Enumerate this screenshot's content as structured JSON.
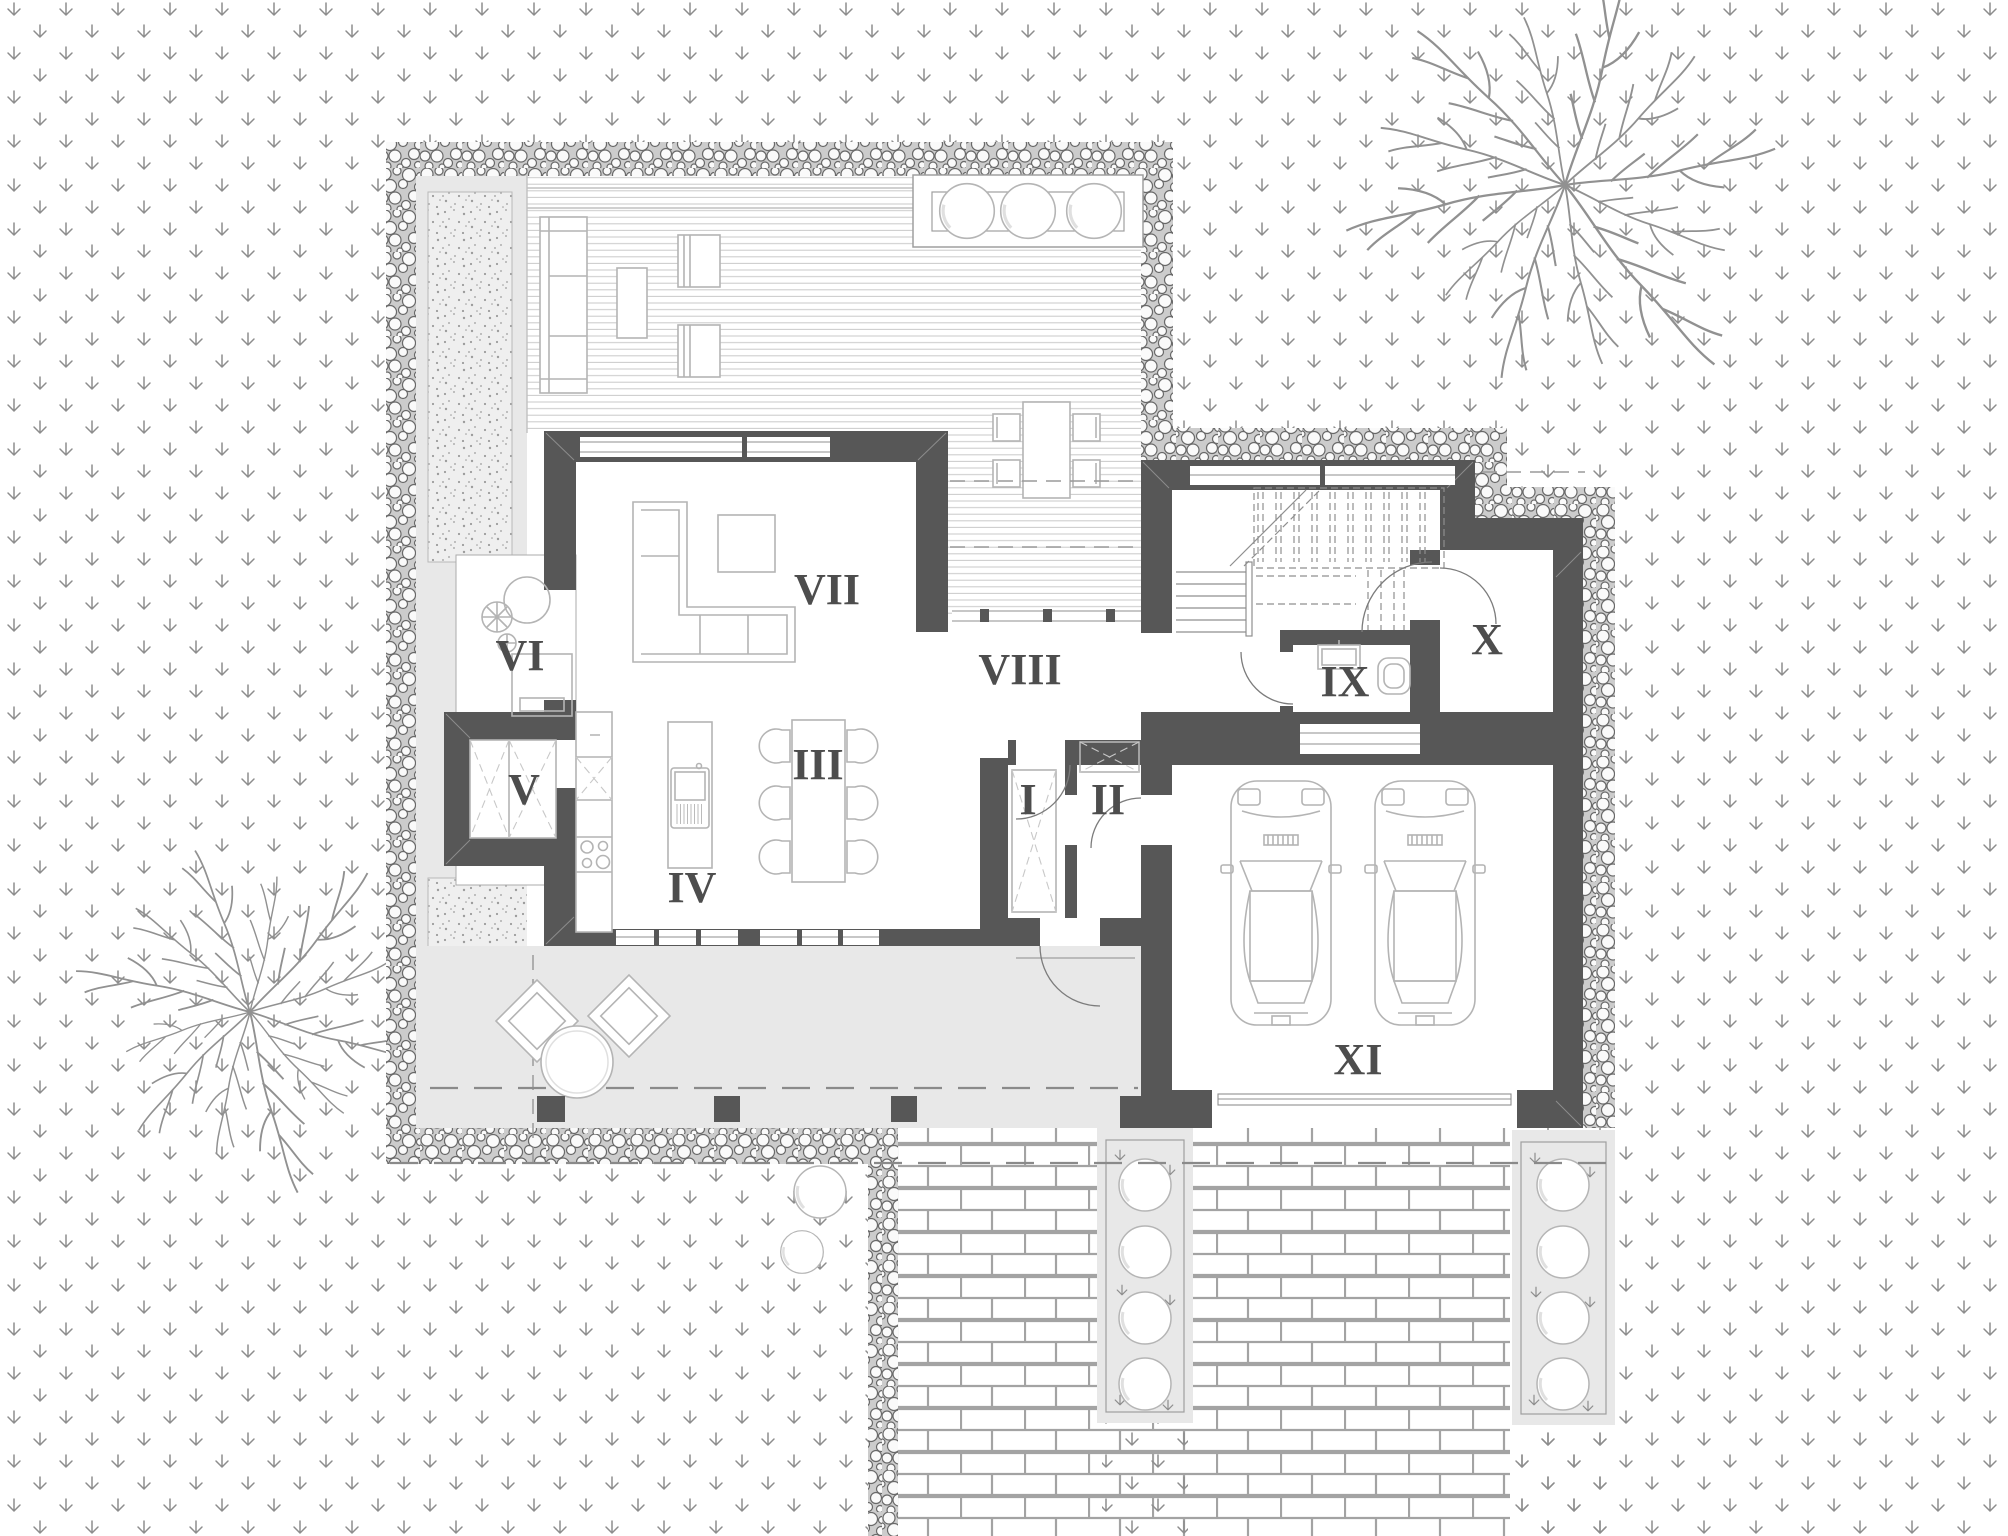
{
  "plan": {
    "rooms": [
      {
        "label": "I",
        "x": 1028,
        "y": 814
      },
      {
        "label": "II",
        "x": 1108,
        "y": 814
      },
      {
        "label": "III",
        "x": 818,
        "y": 779
      },
      {
        "label": "IV",
        "x": 692,
        "y": 902
      },
      {
        "label": "V",
        "x": 524,
        "y": 804
      },
      {
        "label": "VI",
        "x": 520,
        "y": 670
      },
      {
        "label": "VII",
        "x": 827,
        "y": 604
      },
      {
        "label": "VIII",
        "x": 1020,
        "y": 684
      },
      {
        "label": "IX",
        "x": 1345,
        "y": 696
      },
      {
        "label": "X",
        "x": 1487,
        "y": 654
      },
      {
        "label": "XI",
        "x": 1358,
        "y": 1074
      }
    ],
    "objects": {
      "garage_cars": 2,
      "dining_chairs": 6,
      "deck_dining_chairs": 4,
      "deck_planter_bushes": 3,
      "driveway_planter_bushes": 8,
      "terrace_lounge_chairs": 2,
      "trees": 2
    },
    "colors": {
      "background": "#ffffff",
      "walls": "#575757",
      "room_labels": "#4d4d4d",
      "paving_light": "#e8e8e8",
      "furniture_outline": "#b4b4b4",
      "grass_symbol": "#8d8d8d",
      "gravel_stone": "#696969",
      "deck_boards": "#c9c9c9",
      "brick_joints": "#a3a3a3",
      "dashed_lines": "#8a8a8a"
    }
  }
}
